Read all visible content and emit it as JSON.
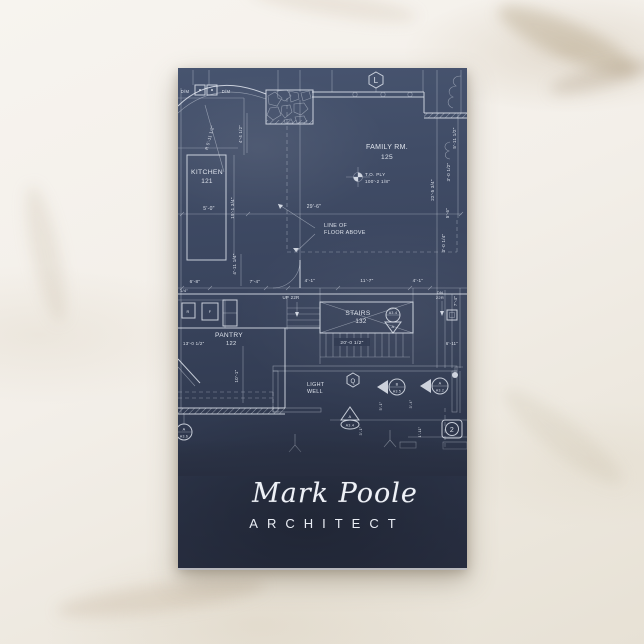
{
  "card": {
    "name": "Mark Poole",
    "title": "ARCHITECT",
    "colors": {
      "card_navy": "#2c3447",
      "card_navy_light": "#42506b",
      "line_white": "#e9eef5",
      "marble": "#f1ede6"
    }
  },
  "blueprint": {
    "rooms": {
      "kitchen": "KITCHEN",
      "kitchen_no": "121",
      "family": "FAMILY RM.",
      "family_no": "125",
      "pantry": "PANTRY",
      "pantry_no": "122",
      "stairs": "STAIRS",
      "stairs_no": "132",
      "light1": "LIGHT",
      "light2": "WELL"
    },
    "notes": {
      "line_of": "LINE OF",
      "floor_above": "FLOOR ABOVE",
      "to_ply": "T.O. PLY",
      "elev": "100'-2 1/8\"",
      "up": "UP 22R",
      "dn": "DN",
      "dn_r": "22R",
      "dm1": "D/M",
      "dm2": "D/M",
      "r": "R",
      "f": "F"
    },
    "dims": {
      "d5_0": "5'-0\"",
      "d29_6": "29'-6\"",
      "d19_1": "19'-1 3/4\"",
      "d4_4": "4'-4 1/2\"",
      "r5_11": "R 5'-11 1/2\"",
      "d4_11": "4'-11 1/4\"",
      "d6_8": "6'-8\"",
      "d7_4a": "7'-4\"",
      "d4_1a": "4'-1\"",
      "d11_7": "11'-7\"",
      "d4_1b": "4'-1\"",
      "d7_4b": "7'-4\"",
      "d20_0": "20'-0 1/2\"",
      "d13_0": "13'-0 1/2\"",
      "d10_1": "10'-1\"",
      "d5_11": "5'-11 1/2\"",
      "d3_0a": "3'-0 1/2\"",
      "d22_5": "22'-5 3/4\"",
      "d5_6": "5'-6\"",
      "d3_0b": "3'-0 1/4\"",
      "d1_4": "1/4\"",
      "d6_11": "6'-11\"",
      "d3_4": "3'-4\"",
      "d5_1": "5'-1\"",
      "d3_1": "3'-1\"",
      "d1_11": "1'-11\""
    },
    "markers": {
      "hex_l": "L",
      "hex_q": "Q",
      "m_a34": "A3.4",
      "m_a34_l": "A",
      "m_a35": "A3.5",
      "m_a35_l": "B",
      "m_a32": "A3.2",
      "m_a32_l": "A",
      "m_a36": "A3.6",
      "m_a36_l": "A",
      "circle_2": "2"
    }
  }
}
